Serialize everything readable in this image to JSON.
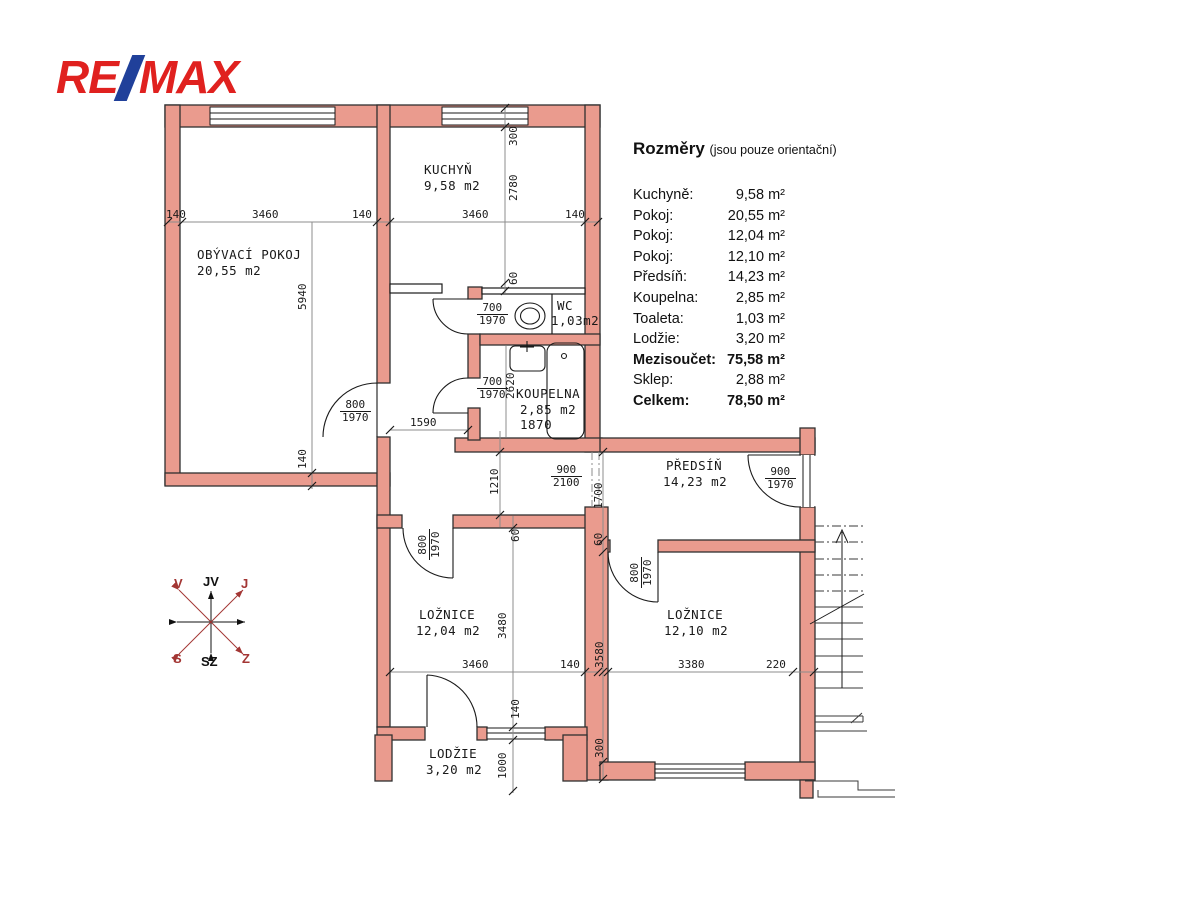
{
  "logo": {
    "part1": "RE",
    "part2": "MAX"
  },
  "legend": {
    "title": "Rozměry",
    "subtitle": "(jsou pouze orientační)",
    "rows": [
      {
        "label": "Kuchyně:",
        "value": "9,58 m²"
      },
      {
        "label": "Pokoj:",
        "value": "20,55 m²"
      },
      {
        "label": "Pokoj:",
        "value": "12,04 m²"
      },
      {
        "label": "Pokoj:",
        "value": "12,10 m²"
      },
      {
        "label": "Předsíň:",
        "value": "14,23 m²"
      },
      {
        "label": "Koupelna:",
        "value": "2,85 m²"
      },
      {
        "label": "Toaleta:",
        "value": "1,03 m²"
      },
      {
        "label": "Lodžie:",
        "value": "3,20 m²"
      },
      {
        "label": "Mezisoučet:",
        "value": "75,58 m²"
      },
      {
        "label": "Sklep:",
        "value": "2,88 m²"
      },
      {
        "label": "Celkem:",
        "value": "78,50 m²"
      }
    ]
  },
  "rooms": {
    "living": {
      "name": "OBÝVACÍ POKOJ",
      "area": "20,55 m2"
    },
    "kitchen": {
      "name": "KUCHYŇ",
      "area": "9,58 m2"
    },
    "wc": {
      "name": "WC",
      "area": "1,03m2"
    },
    "bathroom": {
      "name": "KOUPELNA",
      "area": "2,85 m2",
      "width": "1870"
    },
    "hall": {
      "name": "PŘEDSÍŇ",
      "area": "14,23 m2"
    },
    "bedroom1": {
      "name": "LOŽNICE",
      "area": "12,04 m2"
    },
    "bedroom2": {
      "name": "LOŽNICE",
      "area": "12,10 m2"
    },
    "loggia": {
      "name": "LODŽIE",
      "area": "3,20 m2"
    }
  },
  "doors": {
    "wc": {
      "w": "700",
      "h": "1970"
    },
    "bathroom": {
      "w": "700",
      "h": "1970"
    },
    "living": {
      "w": "800",
      "h": "1970"
    },
    "bedroom1": {
      "w": "800",
      "h": "1970"
    },
    "bedroom2": {
      "w": "800",
      "h": "1970"
    },
    "entry": {
      "w": "900",
      "h": "1970"
    },
    "passage": {
      "w": "900",
      "h": "2100"
    }
  },
  "dims": {
    "top": [
      "140",
      "3460",
      "140",
      "3460",
      "140"
    ],
    "living_v": [
      "5940",
      "140"
    ],
    "kitchen_v": [
      "300",
      "2780",
      "60"
    ],
    "hall_v": "1210",
    "hall_h": "1590",
    "bath_v": "2620",
    "predsin_v": [
      "1700",
      "60"
    ],
    "bed1_v": [
      "60",
      "3480",
      "140",
      "1000"
    ],
    "bed1_h": [
      "3460",
      "140"
    ],
    "bed2_v": [
      "3580",
      "300"
    ],
    "bed2_h": [
      "3380",
      "220"
    ]
  },
  "compass": {
    "top": "JV",
    "top_left": "V",
    "top_right": "J",
    "bottom_left": "S",
    "bottom": "SZ",
    "bottom_right": "Z"
  },
  "colors": {
    "wall_fill": "#EA9B8E",
    "wall_outline": "#303030",
    "logo_red": "#E0211F",
    "logo_blue": "#20409A",
    "compass_red": "#A33634"
  }
}
